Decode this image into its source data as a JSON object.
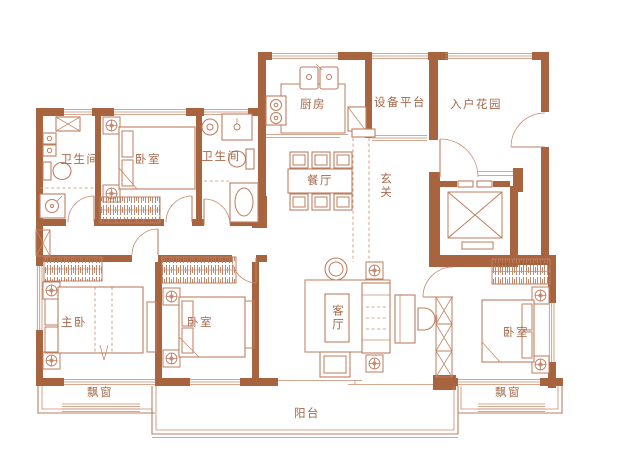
{
  "plan": {
    "type": "residential-floor-plan",
    "labels": {
      "bathroom1": "卫生间",
      "bedroom1": "卧室",
      "bathroom2": "卫生间",
      "kitchen": "厨房",
      "equipment_platform": "设备平台",
      "entry_garden": "入户花园",
      "dining": "餐厅",
      "foyer": "玄关",
      "master_bedroom": "主卧",
      "bedroom2": "卧室",
      "living_room": "客厅",
      "bedroom3": "卧室",
      "bay_window_left": "飘窗",
      "bay_window_right": "飘窗",
      "balcony": "阳台"
    },
    "colors": {
      "wall": "#a8643e",
      "furniture_line": "#bd7d5f",
      "text": "#a5694b",
      "background": "#ffffff"
    }
  }
}
